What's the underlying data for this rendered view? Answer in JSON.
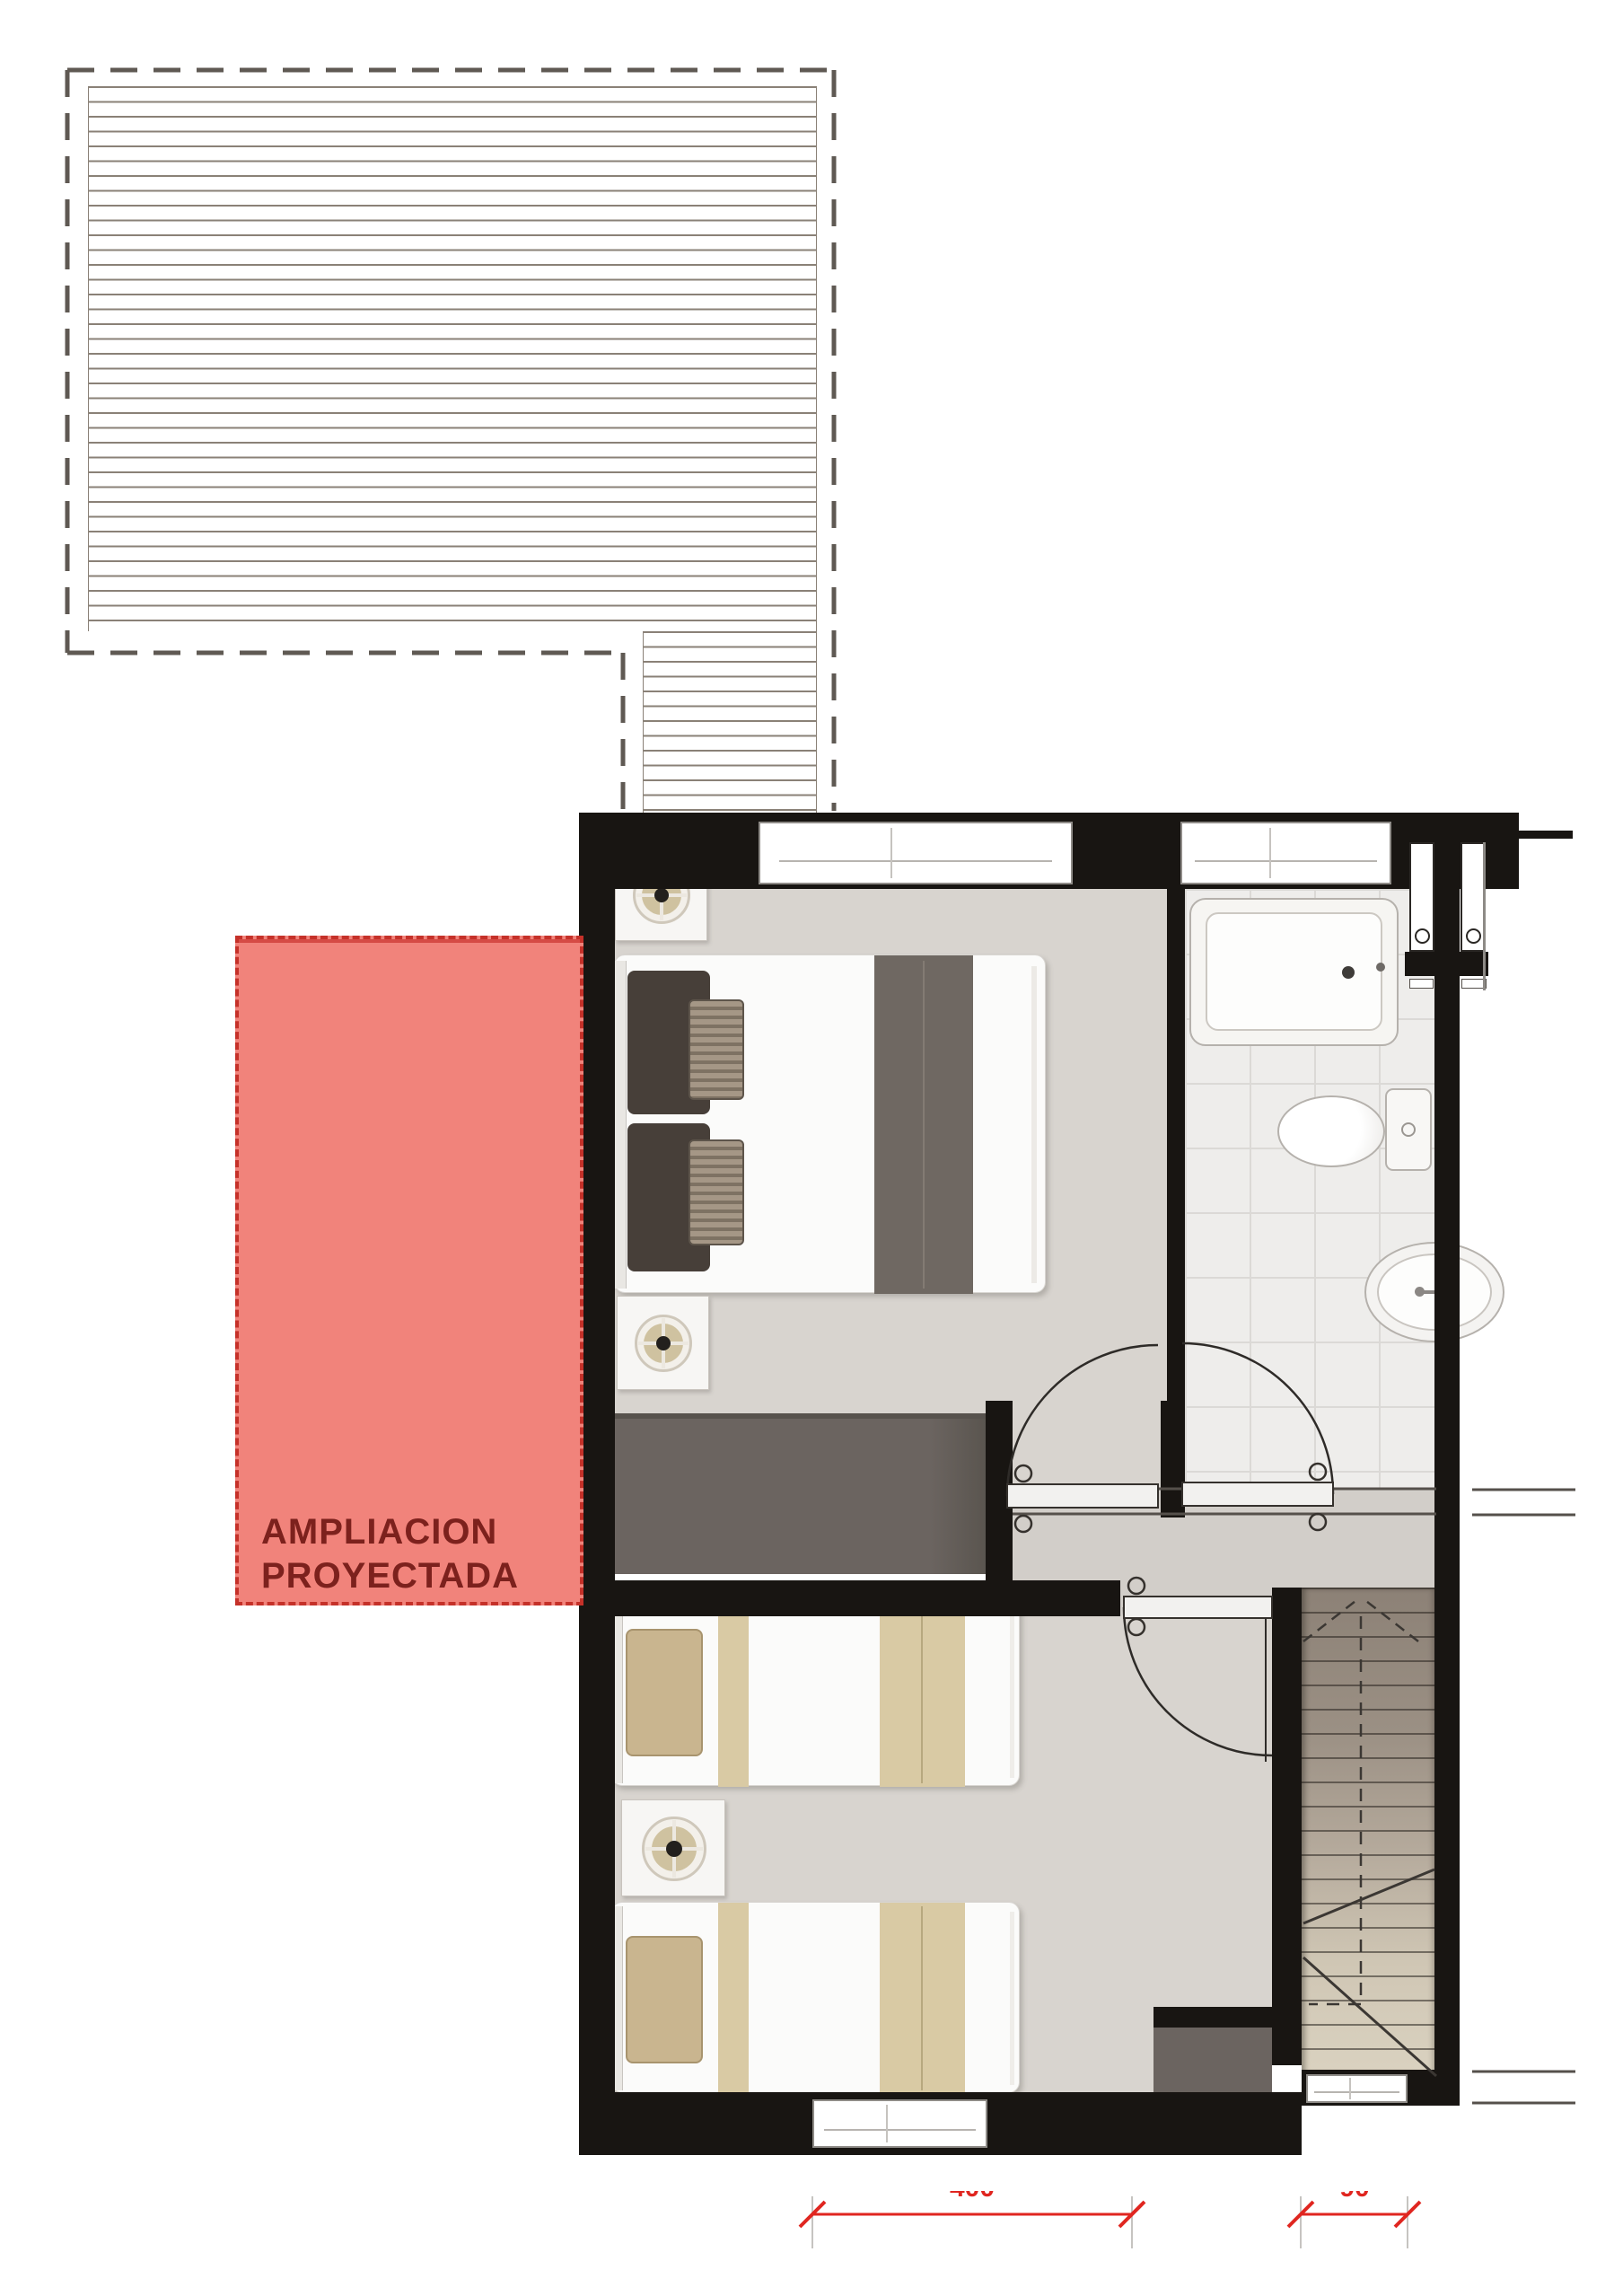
{
  "expansion": {
    "label_line1": "AMPLIACION",
    "label_line2": "PROYECTADA"
  },
  "dimensions": {
    "dim1": "400",
    "dim2": "90"
  },
  "theme": {
    "wall": "#181512",
    "floor": "#d8d4cf",
    "floor-hall": "#d2cec9",
    "bath": "#eeedeb",
    "tile": "#dbd9d6",
    "dark-furn": "#6b6460",
    "stair-top": "#8c8176",
    "stair-bottom": "#ddd5c3",
    "tread": "#3b3733",
    "red-fill": "#f1837b",
    "red-border": "#c53129",
    "red-text": "#7c211d",
    "dim-red": "#e02620",
    "roof-line": "#8a8177",
    "roof-dash": "#5f5953",
    "tan": "#c9b58f",
    "tan-stripe": "#d9caa4",
    "duvet-stripe": "#6f6862",
    "pillow-dark": "#473f39"
  }
}
